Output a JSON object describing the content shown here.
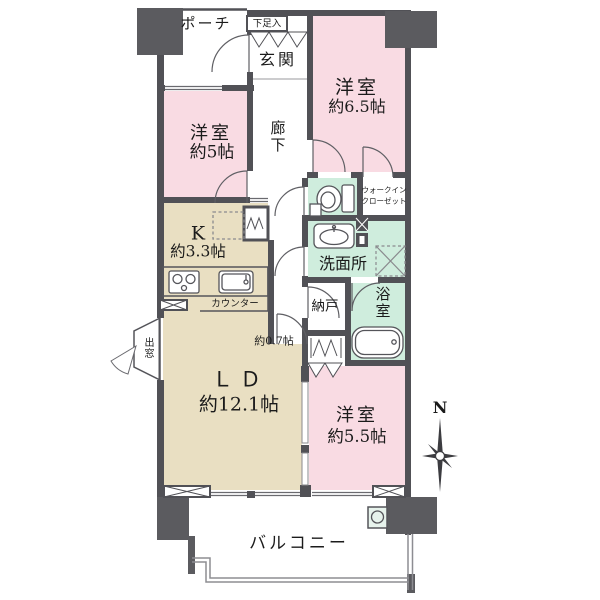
{
  "rooms": {
    "porch": {
      "label": "ポーチ"
    },
    "shoe_cabinet": {
      "label": "下足入"
    },
    "entrance": {
      "label": "玄関"
    },
    "hallway": {
      "label": "廊下"
    },
    "bedroom_6_5": {
      "name": "洋室",
      "size": "約6.5帖"
    },
    "bedroom_5": {
      "name": "洋室",
      "size": "約5帖"
    },
    "walk_in_closet": {
      "line1": "ウォークイン",
      "line2": "クローゼット"
    },
    "washroom": {
      "label": "洗面所"
    },
    "kitchen": {
      "name": "K",
      "size": "約3.3帖"
    },
    "counter": {
      "label": "カウンター"
    },
    "storage_room": {
      "label": "納戸",
      "size": "約0.7帖"
    },
    "bathroom": {
      "label": "浴室"
    },
    "living_dining": {
      "name": "ＬＤ",
      "size": "約12.1帖"
    },
    "bedroom_5_5": {
      "name": "洋室",
      "size": "約5.5帖"
    },
    "balcony": {
      "label": "バルコニー"
    },
    "bay_window": {
      "label": "出窓"
    }
  },
  "compass": {
    "north_label": "N"
  },
  "icons": [
    "toilet-icon",
    "wash-basin-icon",
    "bathtub-icon",
    "stove-icon",
    "kitchen-sink-icon",
    "washing-machine-icon",
    "refrigerator-icon",
    "slop-sink-icon",
    "compass-rose-icon"
  ],
  "colors": {
    "bedroom": "#f9dbe3",
    "wet_area": "#cfeddd",
    "ldk": "#e9dfc2",
    "wall": "#515156",
    "pillar": "#5b5b5f",
    "line": "#55555a"
  }
}
